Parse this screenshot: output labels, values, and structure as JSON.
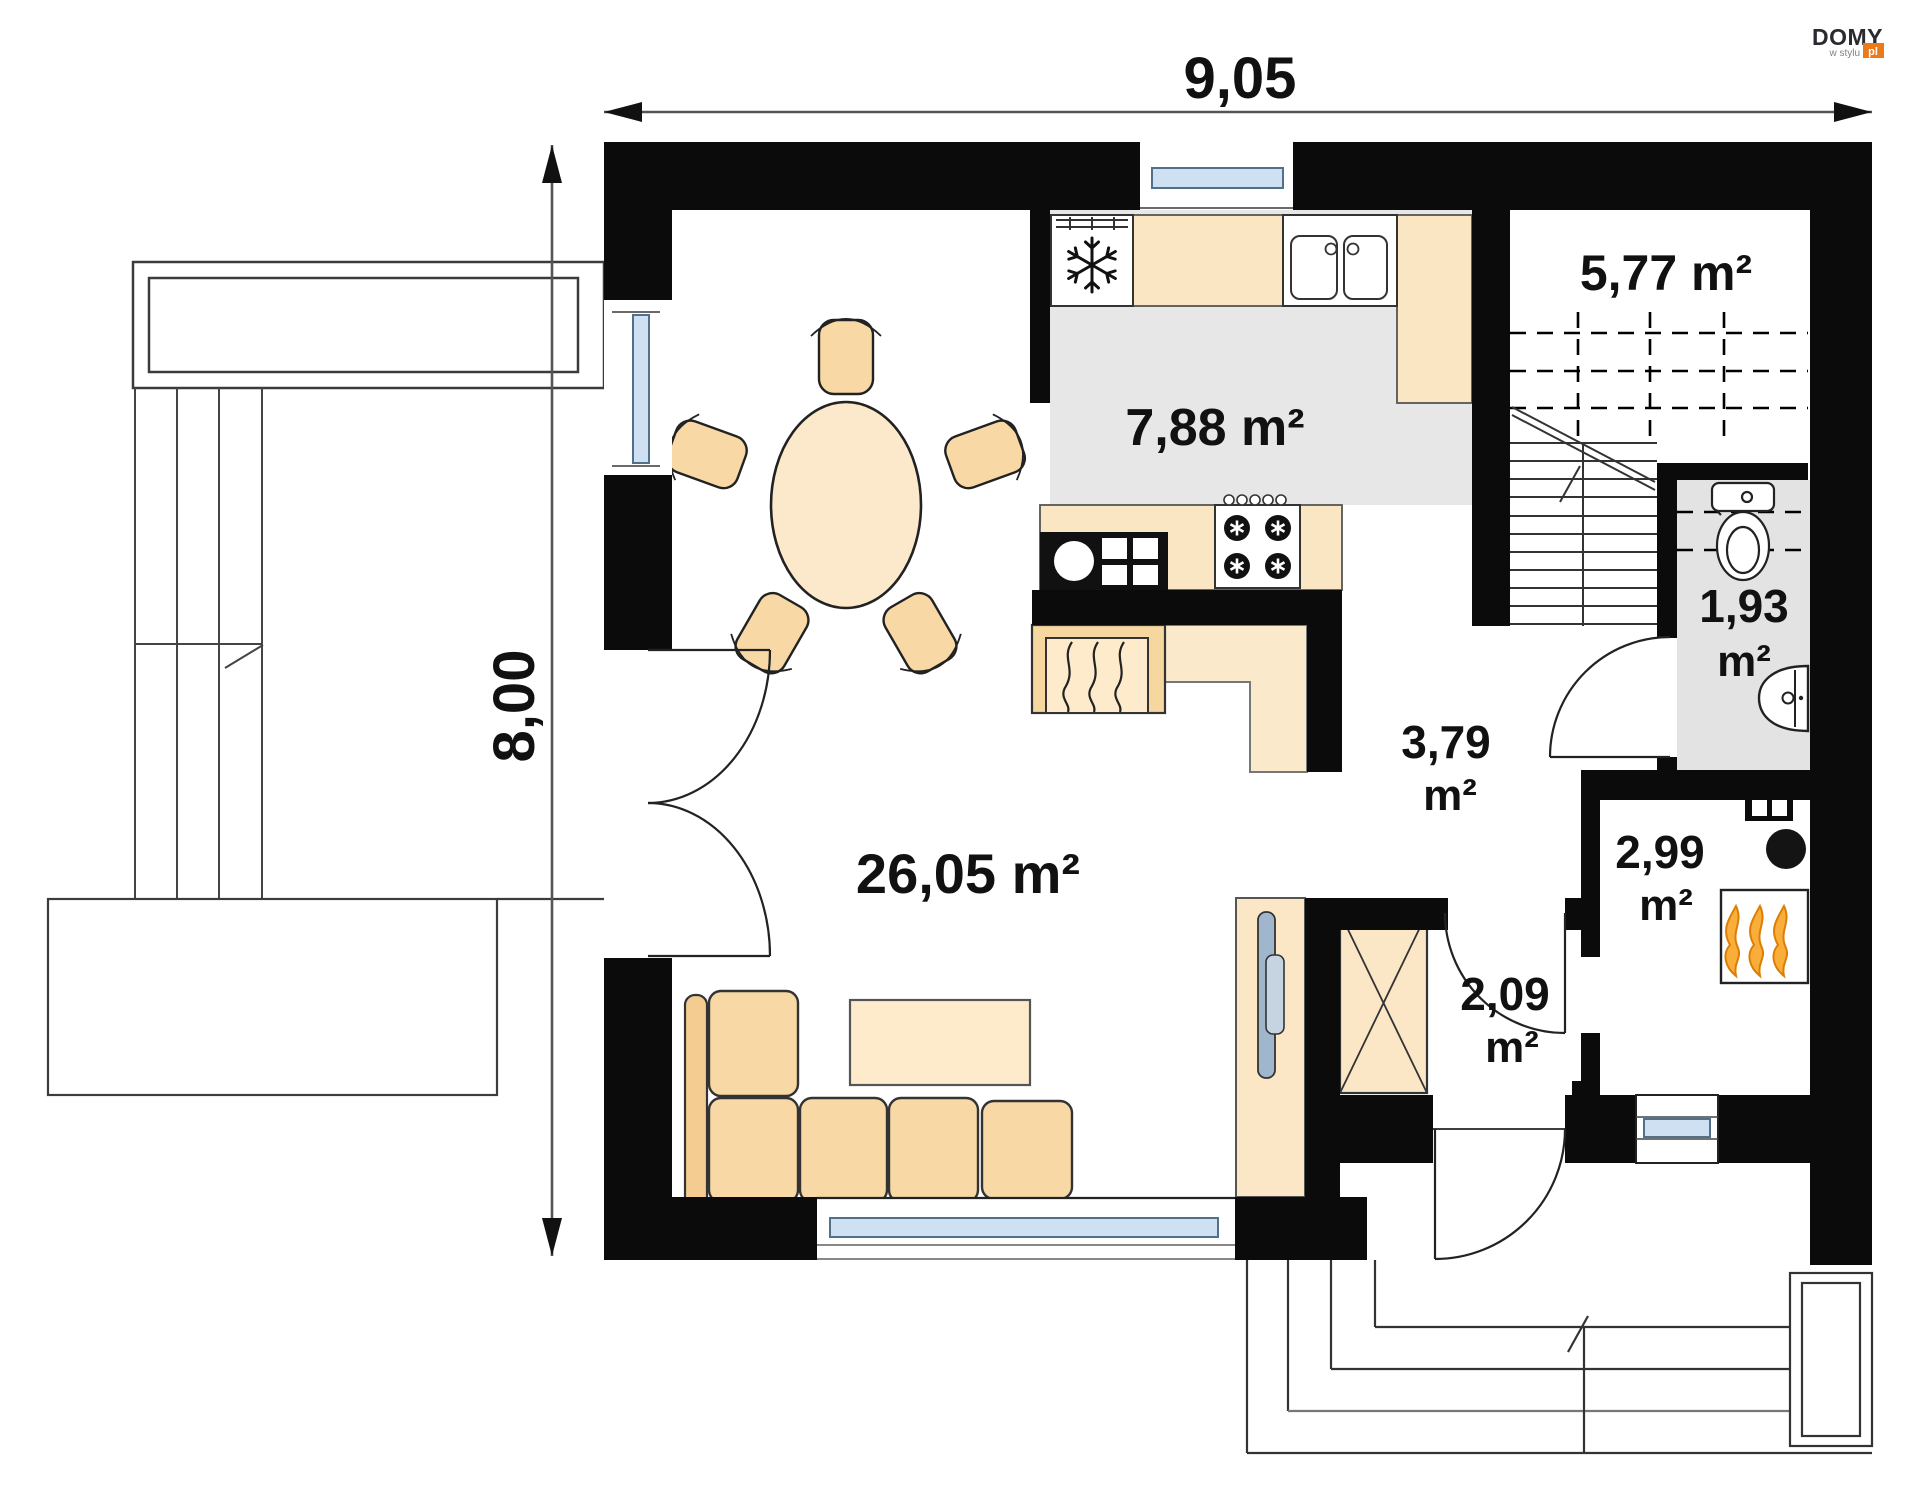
{
  "logo": {
    "brand": "DOMY",
    "tagline": "w stylu",
    "suffix": "pl",
    "accent_color": "#ED7A19",
    "brand_color": "#2A2A31",
    "tagline_color": "#808080"
  },
  "dimensions": {
    "width_label": "9,05",
    "height_label": "8,00"
  },
  "rooms": {
    "staircase": {
      "area_label": "5,77 m²"
    },
    "kitchen": {
      "area_label": "7,88 m²"
    },
    "wc": {
      "area_value": "1,93",
      "area_unit": "m²"
    },
    "hall": {
      "area_value": "3,79",
      "area_unit": "m²"
    },
    "utility": {
      "area_value": "2,99",
      "area_unit": "m²"
    },
    "vestibule": {
      "area_value": "2,09",
      "area_unit": "m²"
    },
    "living": {
      "area_label": "26,05 m²"
    }
  },
  "icons": {
    "fridge": "snowflake-icon",
    "stove": "burner-icon",
    "boiler": "flame-icon",
    "fireplace": "fire-lines-icon"
  },
  "colors": {
    "wall": "#0b0b0b",
    "floor_gray": "#E7E7E7",
    "wc_gray": "#E3E3E3",
    "counter_peach": "#FAE6C3",
    "furniture_peach": "#F8D9A6",
    "furniture_dark_peach": "#F4CC92",
    "light_peach": "#FBE9CC",
    "window_blue": "#CFE0F2",
    "flame_orange": "#F9AE3B"
  }
}
